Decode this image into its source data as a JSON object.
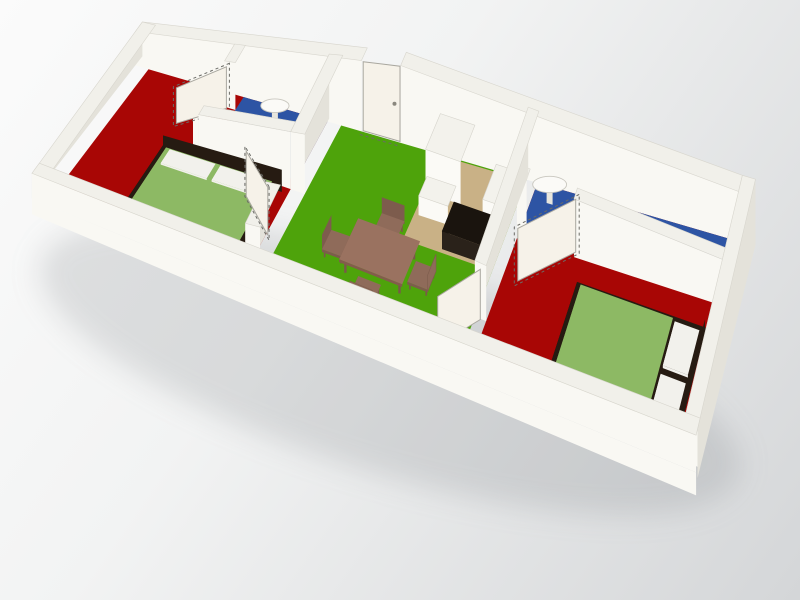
{
  "app": {
    "type": "3d-floorplan-render",
    "description": "Isometric 3D render of an elongated three-room apartment, no visible text"
  },
  "background": {
    "from": "#fbfbfb",
    "mid": "#f2f3f3",
    "to": "#d4d6d8",
    "angle_deg": 125
  },
  "palette": {
    "wallTop": "#f1f0ea",
    "wallS": "#f9f8f3",
    "wallW": "#e4e2da",
    "wallStroke": "#d8d6ce",
    "red": "#a80605",
    "green": "#4ea30b",
    "blue": "#2d54a4",
    "tan": "#c9b186",
    "leaf": "#f6f2e9",
    "leafStroke": "#a9a79f",
    "dash": "#6b6b66",
    "mattress": "#8db964",
    "mattressSide": "#79a351",
    "dark": "#261b12",
    "darkSide": "#170f08",
    "darkS": "#1d1309",
    "pillow": "#f2f1ec",
    "wood": "#9a7260",
    "woodSide": "#835c4c",
    "leg": "#7a584a",
    "chair": "#8f6b5a",
    "chairSide": "#7d5c4d",
    "cabTop": "#f3f2ec",
    "cabS": "#fbfaf6",
    "cabW": "#e7e5dd",
    "cabStroke": "#d6d4cc",
    "blackTop": "#1a140e",
    "blackS": "#2a221a",
    "blackW": "#0d0a06",
    "fixture": "#fbfaf7",
    "fixtureStroke": "#c9c7bf",
    "shadow": "rgba(115,120,124,0.20)"
  },
  "rooms": [
    {
      "name": "bedroom-west",
      "floor_color_key": "red",
      "contents": [
        "double-bed: green mattress, dark frame, white pillows, dark headboard",
        "door to living room"
      ]
    },
    {
      "name": "bathroom-west",
      "floor_color_key": "blue",
      "contents": [
        "wall-mounted sink",
        "open door with dashed swing outline"
      ]
    },
    {
      "name": "living-room",
      "floor_color_key": "green",
      "contents": [
        "dining table with 4 chairs",
        "closed entrance door in north wall"
      ]
    },
    {
      "name": "kitchen-nook",
      "floor_color_key": "tan",
      "contents": [
        "tall white fridge cabinet",
        "white counter",
        "white wall cabinet",
        "black counter unit"
      ]
    },
    {
      "name": "bathroom-east",
      "floor_color_key": "blue",
      "contents": [
        "wall-mounted sink",
        "toilet",
        "open door with dashed swing outline"
      ]
    },
    {
      "name": "bedroom-east",
      "floor_color_key": "red",
      "contents": [
        "double-bed: green mattress, dark frame, white pillows",
        "door to living room"
      ]
    }
  ],
  "scene": {
    "plan_size": {
      "length": 10,
      "width": 3.2
    },
    "calibration": {
      "nw": [
        148,
        66
      ],
      "ne": [
        742,
        238
      ],
      "sw": [
        46,
        200
      ],
      "se": [
        686,
        462
      ],
      "height_profile": [
        [
          0,
          34
        ],
        [
          0.2,
          52
        ],
        [
          0.42,
          78
        ],
        [
          0.62,
          70
        ],
        [
          1,
          50
        ]
      ],
      "depth_gain": -0.25
    },
    "elements": [
      {
        "type": "shadow",
        "name": "ground-shadow",
        "i": false,
        "cx": 390,
        "cy": 368,
        "rx": 365,
        "ry": 105,
        "rot": 17
      },
      {
        "type": "box",
        "name": "north-wall-west",
        "i": false,
        "u1": -0.18,
        "v1": -0.16,
        "u2": 3.62,
        "v2": 0.06,
        "z": 1,
        "c": "wall"
      },
      {
        "type": "box",
        "name": "north-wall-east",
        "i": false,
        "u1": 4.28,
        "v1": -0.16,
        "u2": 9.96,
        "v2": 0.06,
        "z": 1,
        "c": "wall"
      },
      {
        "type": "box",
        "name": "west-wall",
        "i": false,
        "u1": -0.18,
        "v1": -0.16,
        "u2": 0.04,
        "v2": 3.2,
        "z": 1,
        "c": "wall"
      },
      {
        "type": "quad",
        "name": "floor-bedroom-west",
        "i": true,
        "u1": 0.04,
        "v1": 0.06,
        "u2": 3.05,
        "v2": 3.05,
        "fill": "red"
      },
      {
        "type": "quad",
        "name": "floor-living-room",
        "i": true,
        "u1": 3.28,
        "v1": 0.06,
        "u2": 6.4,
        "v2": 3.05,
        "fill": "green"
      },
      {
        "type": "quad",
        "name": "floor-kitchen",
        "i": true,
        "u1": 4.95,
        "v1": 0.08,
        "u2": 6.4,
        "v2": 1.58,
        "fill": "tan"
      },
      {
        "type": "quad",
        "name": "floor-bedroom-east",
        "i": true,
        "u1": 6.58,
        "v1": 0.06,
        "u2": 9.96,
        "v2": 3.05,
        "fill": "red"
      },
      {
        "type": "quad",
        "name": "floor-bathroom-west",
        "i": true,
        "u1": 1.64,
        "v1": 0.06,
        "u2": 3.05,
        "v2": 1.22,
        "fill": "blue"
      },
      {
        "type": "quad",
        "name": "floor-bathroom-east",
        "i": true,
        "u1": 6.58,
        "v1": 0.06,
        "u2": 9.96,
        "v2": 0.82,
        "fill": "blue"
      },
      {
        "type": "dashline",
        "name": "entrance-threshold",
        "i": false,
        "u1": 3.62,
        "v1": 0.12,
        "u2": 4.28,
        "v2": 0.12
      },
      {
        "type": "leaf",
        "name": "entrance-door",
        "i": true,
        "u1": 3.64,
        "v1": 0.04,
        "u2": 4.26,
        "v2": 0.04,
        "z": 0.97,
        "handle": true
      },
      {
        "type": "sink",
        "name": "bathroom-west-sink",
        "i": true,
        "u": 2.3,
        "v": 0.26
      },
      {
        "type": "box",
        "name": "bathroom-west-wall-a",
        "i": false,
        "u1": 1.46,
        "v1": 0,
        "u2": 1.64,
        "v2": 0.34,
        "z": 1,
        "c": "wall"
      },
      {
        "type": "box",
        "name": "bathroom-west-wall-b",
        "i": false,
        "u1": 1.46,
        "v1": 1.04,
        "u2": 1.64,
        "v2": 1.4,
        "z": 1,
        "c": "wall"
      },
      {
        "type": "leaf",
        "name": "bathroom-west-door",
        "i": true,
        "u1": 1.5,
        "v1": 0.36,
        "u2": 0.95,
        "v2": 0.92,
        "z": 0.9,
        "dash": true
      },
      {
        "type": "box",
        "name": "bathroom-west-wall-south",
        "i": false,
        "u1": 1.55,
        "v1": 1.22,
        "u2": 3.05,
        "v2": 1.4,
        "z": 1,
        "c": "wall"
      },
      {
        "type": "standing",
        "name": "bed-west-headboard",
        "i": true,
        "u1": 1.02,
        "v1": 1.5,
        "u2": 2.95,
        "v2": 1.5,
        "z1": 0,
        "z2": 0.4,
        "fill": "dark"
      },
      {
        "type": "box",
        "name": "bed-west-frame",
        "i": true,
        "u1": 1.02,
        "v1": 1.5,
        "u2": 2.95,
        "v2": 2.98,
        "z": 0.14,
        "c": "darkbox"
      },
      {
        "type": "slab",
        "name": "bed-west-mattress",
        "i": true,
        "u1": 1.1,
        "v1": 1.56,
        "u2": 2.82,
        "v2": 2.9,
        "z1": 0.14,
        "z2": 0.2,
        "top": "mattress",
        "side": "mattressSide"
      },
      {
        "type": "slab",
        "name": "bed-west-pillow-1",
        "i": false,
        "u1": 1.18,
        "v1": 1.6,
        "u2": 1.92,
        "v2": 1.9,
        "z1": 0.2,
        "z2": 0.24,
        "top": "pillow",
        "side": "pillow"
      },
      {
        "type": "slab",
        "name": "bed-west-pillow-2",
        "i": false,
        "u1": 2.0,
        "v1": 1.6,
        "u2": 2.74,
        "v2": 1.9,
        "z1": 0.2,
        "z2": 0.24,
        "top": "pillow",
        "side": "pillow"
      },
      {
        "type": "box",
        "name": "wall-west-divider-a",
        "i": false,
        "u1": 3.05,
        "v1": 0,
        "u2": 3.28,
        "v2": 1.4,
        "z": 1,
        "c": "wall"
      },
      {
        "type": "box",
        "name": "wall-west-divider-b",
        "i": false,
        "u1": 3.05,
        "v1": 2.3,
        "u2": 3.28,
        "v2": 3.05,
        "z": 1,
        "c": "wall"
      },
      {
        "type": "leaf",
        "name": "bedroom-west-door",
        "i": true,
        "u1": 3.08,
        "v1": 2.3,
        "u2": 2.5,
        "v2": 1.78,
        "z": 0.9,
        "dash": true
      },
      {
        "type": "box",
        "name": "kitchen-fridge",
        "i": true,
        "u1": 4.98,
        "v1": 0.14,
        "u2": 5.56,
        "v2": 0.74,
        "z": 0.62,
        "c": "cab"
      },
      {
        "type": "box",
        "name": "kitchen-counter",
        "i": true,
        "u1": 5.02,
        "v1": 0.78,
        "u2": 5.5,
        "v2": 1.12,
        "z": 0.28,
        "c": "cab"
      },
      {
        "type": "box",
        "name": "kitchen-cabinet-east",
        "i": true,
        "u1": 5.98,
        "v1": 0.3,
        "u2": 6.38,
        "v2": 0.88,
        "z": 0.32,
        "c": "cab"
      },
      {
        "type": "box",
        "name": "kitchen-black-counter",
        "i": true,
        "u1": 5.56,
        "v1": 1.02,
        "u2": 6.38,
        "v2": 1.52,
        "z": 0.28,
        "c": "black"
      },
      {
        "type": "sink",
        "name": "bathroom-east-sink",
        "i": true,
        "u": 6.88,
        "v": 0.24
      },
      {
        "type": "box",
        "name": "toilet",
        "i": true,
        "u1": 8.85,
        "v1": 0.44,
        "u2": 9.18,
        "v2": 0.8,
        "z": 0.16,
        "c": "cab",
        "ellipseTop": true
      },
      {
        "type": "box",
        "name": "bathroom-east-wall-a",
        "i": false,
        "u1": 6.58,
        "v1": 0.82,
        "u2": 6.74,
        "v2": 0.98,
        "z": 1,
        "c": "wall"
      },
      {
        "type": "box",
        "name": "bathroom-east-wall-b",
        "i": false,
        "u1": 7.52,
        "v1": 0.82,
        "u2": 9.96,
        "v2": 0.98,
        "z": 1,
        "c": "wall"
      },
      {
        "type": "leaf",
        "name": "bathroom-east-door",
        "i": true,
        "u1": 7.52,
        "v1": 0.9,
        "u2": 6.82,
        "v2": 1.6,
        "z": 0.9,
        "dash": true
      },
      {
        "type": "chair",
        "name": "dining-chair-north",
        "i": true,
        "u1": 4.55,
        "v1": 1.44,
        "u2": 4.92,
        "v2": 1.74,
        "back": "n"
      },
      {
        "type": "chair",
        "name": "dining-chair-west",
        "i": true,
        "u1": 3.96,
        "v1": 1.98,
        "u2": 4.28,
        "v2": 2.34,
        "back": "w"
      },
      {
        "type": "chair",
        "name": "dining-chair-east",
        "i": true,
        "u1": 5.32,
        "v1": 1.98,
        "u2": 5.64,
        "v2": 2.34,
        "back": "e"
      },
      {
        "type": "table",
        "name": "dining-table",
        "i": true,
        "u1": 4.3,
        "v1": 1.76,
        "u2": 5.3,
        "v2": 2.5,
        "z1": 0.205,
        "z2": 0.25
      },
      {
        "type": "chair",
        "name": "dining-chair-south",
        "i": true,
        "u1": 4.62,
        "v1": 2.54,
        "u2": 4.98,
        "v2": 2.88,
        "back": "s"
      },
      {
        "type": "box",
        "name": "bed-east-frame",
        "i": true,
        "u1": 7.72,
        "v1": 1.42,
        "u2": 9.82,
        "v2": 3.0,
        "z": 0.13,
        "c": "darkbox"
      },
      {
        "type": "slab",
        "name": "bed-east-mattress",
        "i": true,
        "u1": 7.8,
        "v1": 1.48,
        "u2": 9.3,
        "v2": 2.94,
        "z1": 0.13,
        "z2": 0.185,
        "top": "mattress",
        "side": "mattressSide"
      },
      {
        "type": "slab",
        "name": "bed-east-pillow-1",
        "i": false,
        "u1": 9.34,
        "v1": 1.52,
        "u2": 9.74,
        "v2": 2.16,
        "z1": 0.13,
        "z2": 0.19,
        "top": "pillow",
        "side": "pillow"
      },
      {
        "type": "slab",
        "name": "bed-east-pillow-2",
        "i": false,
        "u1": 9.34,
        "v1": 2.28,
        "u2": 9.74,
        "v2": 2.92,
        "z1": 0.13,
        "z2": 0.19,
        "top": "pillow",
        "side": "pillow"
      },
      {
        "type": "standing",
        "name": "bed-east-headboard",
        "i": true,
        "u1": 9.8,
        "v1": 1.42,
        "u2": 9.8,
        "v2": 3.0,
        "z1": 0,
        "z2": 0.3,
        "fill": "dark"
      },
      {
        "type": "box",
        "name": "wall-east-divider",
        "i": false,
        "u1": 6.4,
        "v1": 0,
        "u2": 6.58,
        "v2": 2.35,
        "z": 1,
        "c": "wall"
      },
      {
        "type": "leaf",
        "name": "bedroom-east-door",
        "i": true,
        "u1": 6.49,
        "v1": 2.36,
        "u2": 6.04,
        "v2": 2.98,
        "z": 0.9
      },
      {
        "type": "box",
        "name": "east-wall",
        "i": false,
        "u1": 9.96,
        "v1": -0.16,
        "u2": 10.18,
        "v2": 3.2,
        "z": 1,
        "c": "wall",
        "eastFace": true
      },
      {
        "type": "box",
        "name": "south-wall-top",
        "i": false,
        "u1": -0.18,
        "v1": 3.05,
        "u2": 10.18,
        "v2": 3.28,
        "z": 1,
        "c": "wall"
      },
      {
        "type": "facade",
        "name": "south-facade",
        "i": false,
        "u1": -0.18,
        "u2": 10.18,
        "v": 3.28,
        "zTop": 0,
        "zBot": -0.62
      }
    ]
  }
}
